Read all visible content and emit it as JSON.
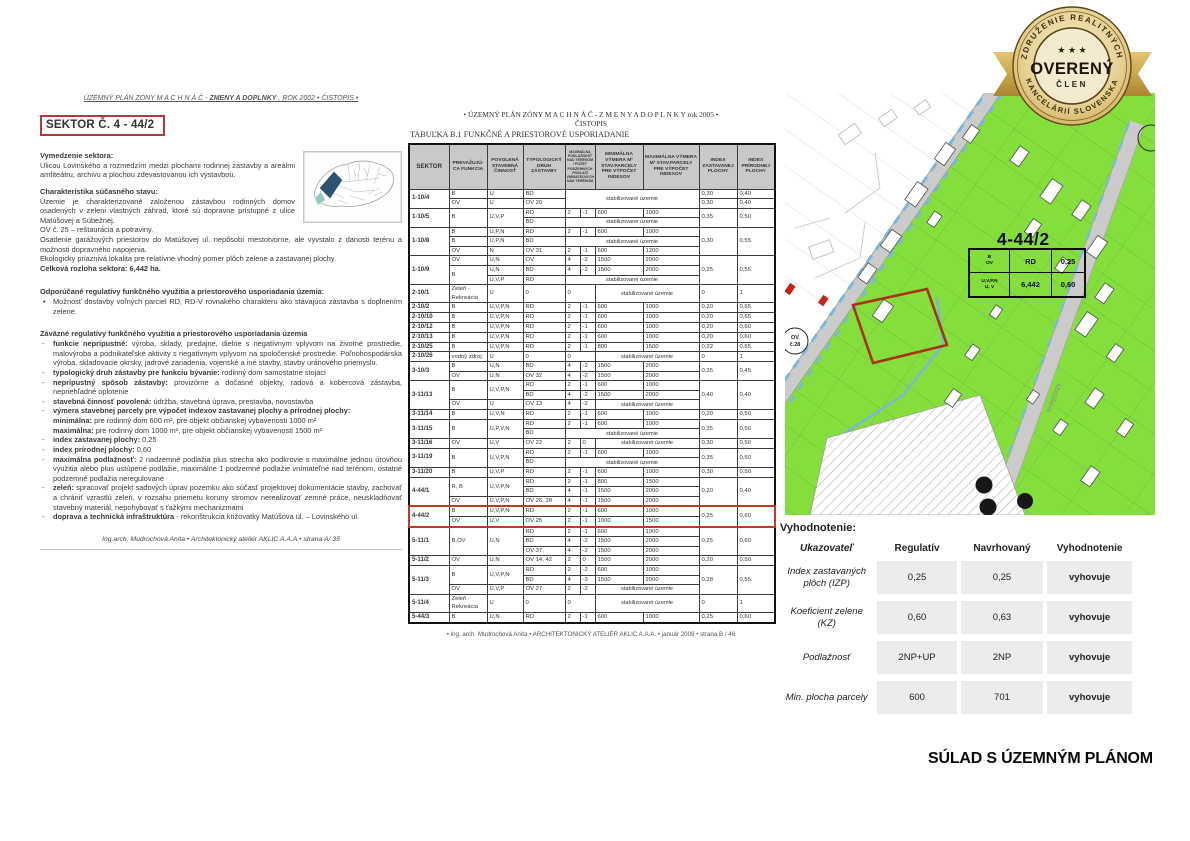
{
  "left_page": {
    "header": {
      "pre": "ÚZEMNÝ PLÁN ZÓNY  M A C H N Á Č  - ",
      "bold": "ZMENY A DOPLNKY",
      "post": " , ROK 2002 • ČISTOPIS •"
    },
    "sector_title": "SEKTOR Č. 4 - 44/2",
    "vymedzenie": {
      "heading": "Vymedzenie sektora:",
      "body": "Ulicou Lovinského a rozmedzím medzi plochami rodinnej zástavby a areálmi amfiteátru, archivu a plochou zdevastovanou ich výstavbou."
    },
    "charakteristika": {
      "heading": "Charakteristika súčasného stavu:",
      "paragraphs": [
        "Územie je charakterizované založenou zástavbou rodinných domov osadených v zeleni vlastných záhrad, ktoré sú dopravne prístupné z ulice Matúšovej a Súbežnej.",
        "OV č. 25 – reštaurácia a potraviny.",
        "Osadenie garážových priestorov do Matúšovej ul. nepôsobí mestotvorne, ale vyvstalo z danosti terénu a možnosti dopravného napojenia.",
        "Ekologicky priaznivá lokalita pre relatívne vhodný pomer plôch zelene a zastavanej plochy."
      ],
      "total": "Celková rozloha sektora: 6,442 ha."
    },
    "odporucane": {
      "heading": "Odporúčané regulatívy funkčného využitia a priestorového usporiadania územia:",
      "bullet": "Možnosť dostavby voľných parciel RD, RD-V rovnakého charakteru ako stávajúca zástavba s doplnením zelene."
    },
    "zavazne_heading": "Záväzné regulatívy funkčného využitia a priestorového usporiadania územia",
    "regulativy": [
      {
        "d": 1,
        "lead": "funkcie neprípustné:",
        "rest": "výroba, sklady, predajne, dielne s negatívnym vplyvom na životné prostredie, malovýroba a podnikateľské aktivity s negatívnym vplyvom na spoločenské prostredie. Poľnohospodárska výroba, skladovacie okrsky, jadrové zariadenia, vojenské a iné stavby, stavby uránového priemyslu."
      },
      {
        "d": 1,
        "lead": "typologický druh zástavby pre funkciu bývanie:",
        "rest": "rodinný dom samostatne stojaci"
      },
      {
        "d": 1,
        "lead": "neprípustný spôsob zástavby:",
        "rest": "provizórne a dočasné objekty, radová a kobercová zástavba, nepriehľadné oplotenie"
      },
      {
        "d": 1,
        "lead": "stavebná činnosť povolená:",
        "rest": "údržba, stavebná úprava, prestavba, novostavba"
      },
      {
        "d": 1,
        "lead": "výmera stavebnej parcely pre výpočet indexov zastavanej plochy a prírodnej plochy:",
        "rest": ""
      },
      {
        "d": 0,
        "lead": "minimálna:",
        "rest": "pre rodinný dom 600 m², pre objekt  občianskej vybavenosti 1000 m²"
      },
      {
        "d": 0,
        "lead": "maximálna:",
        "rest": "pre rodinný dom 1000 m², pre objekt občianskej vybavenosti 1500 m²"
      },
      {
        "d": 1,
        "lead": "index zastavanej plochy:",
        "rest": "0,25"
      },
      {
        "d": 1,
        "lead": "index prírodnej plochy:",
        "rest": "0,60"
      },
      {
        "d": 1,
        "lead": "maximálna podlažnosť:",
        "rest": "2 nadzemné podlažia  plus strecha ako podkrovie s maximálne jednou úrovňou využitia alebo plus ustúpené podlažie, maximálne 1 podzemné podlažie vnímateľné nad terénom, ostatné podzemné podlažia neregulované"
      },
      {
        "d": 1,
        "lead": "zeleň:",
        "rest": "spracovať projekt sadových úprav pozemku ako súčasť projektovej dokumentácie stavby, zachovať a chrániť vzrastlú zeleň, v rozsahu priemetu koruny stromov nerealizovať zemné práce, neuskladňovať stavebný materiál, nepohybovať s ťažkými mechanizmami"
      },
      {
        "d": 1,
        "lead": "doprava a technická infraštruktúra",
        "rest": "- rekonštrukcia križovatky Matúšova ul. – Lovinského ul."
      }
    ],
    "footer": "Ing.arch. Mudrochová Anita • Architektonický ateliér AKLIC A.A.A.• strana A/ 35"
  },
  "middle_page": {
    "header_line1": "• ÚZEMNÝ PLÁN ZÓNY   M A C H N Á Č - Z M E N Y  A  D O P L N K Y   rok 2005  •",
    "header_line2": "ČISTOPIS",
    "table_title": "TABUĽKA   B.1   FUNKČNÉ  A PRIESTOROVÉ   USPORIADANIE",
    "columns": [
      "SEKTOR",
      "PREVAŽUJÚ- CA FUNKCIA",
      "POVOLENÁ STAVEBNÁ ČINNOSŤ",
      "TYPOLOGICKÝ DRUH ZÁSTAVBY",
      "MAXIMÁLNA PODLAŽNOSŤ NAD TERÉNOM / POČET PODZEMNÝCH PODLAŽÍ VNÍMATEĽNÝCH NAD TERÉNOM",
      "MINIMÁLNA VÝMERA M² STAV.PARCELY PRE VÝPOČET INDEXOV",
      "MAXIMÁLNA VÝMERA M² STAV.PARCELY PRE VÝPOČET INDEXOV",
      "INDEX ZASTAVANEJ PLOCHY",
      "INDEX PRÍRODNEJ PLOCHY"
    ],
    "groups": [
      {
        "sektor": "1-10/4",
        "rows": [
          [
            "B",
            "U",
            "BD",
            {
              "t": "stabilizované územie",
              "cs": 4,
              "rs": 2,
              "cls": "stab"
            },
            "0,30",
            "0,40"
          ],
          [
            "OV",
            "U",
            "OV 20",
            "0,30",
            "0,40"
          ]
        ]
      },
      {
        "sektor": "1-10/5",
        "rows": [
          [
            {
              "t": "B",
              "rs": 2
            },
            {
              "t": "U,V,P",
              "rs": 2
            },
            "RD",
            "2",
            "-1",
            "600",
            "1000",
            {
              "t": "0,35",
              "rs": 2
            },
            {
              "t": "0,50",
              "rs": 2
            }
          ],
          [
            "BD",
            {
              "t": "stabilizované územie",
              "cs": 4,
              "cls": "stab"
            }
          ]
        ]
      },
      {
        "sektor": "1-10/8",
        "rows": [
          [
            "B",
            "U,P,N",
            "RD",
            "2",
            "-1",
            "600",
            "1000",
            {
              "t": "0,30",
              "rs": 3
            },
            {
              "t": "0,55",
              "rs": 3
            }
          ],
          [
            "B",
            "U,P,N",
            "BD",
            {
              "t": "stabilizované územie",
              "cs": 4,
              "cls": "stab"
            }
          ],
          [
            "OV",
            "N",
            "OV 31",
            "2",
            "-1",
            "600",
            "1200"
          ]
        ]
      },
      {
        "sektor": "1-10/9",
        "rows": [
          [
            "OV",
            "U,N",
            "OV",
            "4",
            "-2",
            "1500",
            "2000",
            {
              "t": "0,25",
              "rs": 3
            },
            {
              "t": "0,55",
              "rs": 3
            }
          ],
          [
            {
              "t": "B",
              "rs": 2
            },
            "U,N",
            "BD",
            "4",
            "-2",
            "1500",
            "2000"
          ],
          [
            "U,V,P",
            "RD",
            {
              "t": "stabilizované územie",
              "cs": 4,
              "cls": "stab"
            }
          ]
        ]
      },
      {
        "sektor": "2-10/1",
        "rows": [
          [
            "Zeleň - Rekreácia",
            "U",
            "0",
            {
              "t": "0",
              "cs": 2
            },
            {
              "t": "stabilizované územie",
              "cs": 2,
              "cls": "stab"
            },
            "0",
            "1"
          ]
        ]
      },
      {
        "sektor": "2-10/2",
        "rows": [
          [
            "B",
            "U,V,P,N",
            "RD",
            "2",
            "-1",
            "600",
            "1000",
            "0,20",
            "0,65"
          ]
        ]
      },
      {
        "sektor": "2-10/10",
        "rows": [
          [
            "B",
            "U,V,P,N",
            "RD",
            "2",
            "-1",
            "600",
            "1000",
            "0,20",
            "0,65"
          ]
        ]
      },
      {
        "sektor": "2-10/12",
        "rows": [
          [
            "B",
            "U,V,P,N",
            "RD",
            "2",
            "-1",
            "600",
            "1000",
            "0,20",
            "0,60"
          ]
        ]
      },
      {
        "sektor": "2-10/13",
        "rows": [
          [
            "B",
            "U,V,P,N",
            "RD",
            "2",
            "-1",
            "600",
            "1000",
            "0,20",
            "0,60"
          ]
        ]
      },
      {
        "sektor": "2-10/25",
        "rows": [
          [
            "B",
            "U,V,P,N",
            "RD",
            "2",
            "-1",
            "800",
            "1500",
            "0,22",
            "0,65"
          ]
        ]
      },
      {
        "sektor": "2-10/26",
        "rows": [
          [
            "vodný zdroj",
            "U",
            "0",
            {
              "t": "0",
              "cs": 2
            },
            {
              "t": "stabilizované územie",
              "cs": 2,
              "cls": "stab"
            },
            "0",
            "1"
          ]
        ]
      },
      {
        "sektor": "3-10/3",
        "rows": [
          [
            "B",
            "U,N",
            "BD",
            "4",
            "-2",
            "1500",
            "2000",
            {
              "t": "0,35",
              "rs": 2
            },
            {
              "t": "0,45",
              "rs": 2
            }
          ],
          [
            "OV",
            "U,N",
            "OV 32",
            "4",
            "-2",
            "1500",
            "2000"
          ]
        ]
      },
      {
        "sektor": "3-11/13",
        "rows": [
          [
            {
              "t": "B",
              "rs": 2
            },
            {
              "t": "U,V,P,N",
              "rs": 2
            },
            "RD",
            "2",
            "-1",
            "600",
            "1000",
            {
              "t": "0,40",
              "rs": 3
            },
            {
              "t": "0,40",
              "rs": 3
            }
          ],
          [
            "BD",
            "4",
            "-2",
            "1500",
            "2000"
          ],
          [
            "OV",
            "U",
            "OV 13",
            "4",
            "-2",
            {
              "t": "stabilizované územie",
              "cs": 2,
              "cls": "stab"
            }
          ]
        ]
      },
      {
        "sektor": "3-11/14",
        "rows": [
          [
            "B",
            "U,V,N",
            "RD",
            "2",
            "-1",
            "600",
            "1000",
            "0,20",
            "0,50"
          ]
        ]
      },
      {
        "sektor": "3-11/15",
        "rows": [
          [
            {
              "t": "B",
              "rs": 2
            },
            {
              "t": "U,P,V,N",
              "rs": 2
            },
            "RD",
            "2",
            "-1",
            "600",
            "1000",
            {
              "t": "0,35",
              "rs": 2
            },
            {
              "t": "0,50",
              "rs": 2
            }
          ],
          [
            "BD",
            {
              "t": "stabilizované územie",
              "cs": 4,
              "cls": "stab"
            }
          ]
        ]
      },
      {
        "sektor": "3-11/16",
        "rows": [
          [
            "OV",
            "U,V",
            "OV 22",
            "2",
            "0",
            {
              "t": "stabilizované územie",
              "cs": 2,
              "cls": "stab"
            },
            "0,30",
            "0,50"
          ]
        ]
      },
      {
        "sektor": "3-11/19",
        "rows": [
          [
            {
              "t": "B",
              "rs": 2
            },
            {
              "t": "U,V,P,N",
              "rs": 2
            },
            "RD",
            "2",
            "-1",
            "600",
            "1000",
            {
              "t": "0,35",
              "rs": 2
            },
            {
              "t": "0,50",
              "rs": 2
            }
          ],
          [
            "BD",
            {
              "t": "stabilizované územie",
              "cs": 4,
              "cls": "stab"
            }
          ]
        ]
      },
      {
        "sektor": "3-11/20",
        "rows": [
          [
            "B",
            "U,V,P",
            "RD",
            "2",
            "-1",
            "600",
            "1000",
            "0,30",
            "0,50"
          ]
        ]
      },
      {
        "sektor": "4-44/1",
        "rows": [
          [
            {
              "t": "R, B",
              "rs": 2
            },
            {
              "t": "U,V,P,N",
              "rs": 2
            },
            "RD",
            "2",
            "-1",
            "800",
            "1500",
            {
              "t": "0,20",
              "rs": 3
            },
            {
              "t": "0,40",
              "rs": 3
            }
          ],
          [
            "BD",
            "4",
            "-1",
            "1500",
            "2000"
          ],
          [
            "OV",
            "U,V,P,N",
            "OV 26, 28",
            "4",
            "-1",
            "1500",
            "2000"
          ]
        ]
      },
      {
        "sektor": "4-44/2",
        "hl": true,
        "rows": [
          [
            "B",
            "U,V,P,N",
            "RD",
            "2",
            "-1",
            "600",
            "1000",
            {
              "t": "0,25",
              "rs": 2
            },
            {
              "t": "0,60",
              "rs": 2
            }
          ],
          [
            "OV",
            "U,V",
            "OV 25",
            "2",
            "-1",
            "1000",
            "1500"
          ]
        ]
      },
      {
        "sektor": "5-11/1",
        "rows": [
          [
            {
              "t": "B,OV",
              "rs": 3
            },
            {
              "t": "U,N",
              "rs": 3
            },
            "RD",
            "2",
            "-1",
            "600",
            "1000",
            {
              "t": "0,25",
              "rs": 3
            },
            {
              "t": "0,60",
              "rs": 3
            }
          ],
          [
            "BD",
            "4",
            "-2",
            "1500",
            "2000"
          ],
          [
            "OV 37,",
            "4",
            "-2",
            "1500",
            "2000"
          ]
        ]
      },
      {
        "sektor": "5-11/2",
        "rows": [
          [
            "OV",
            "U,N",
            "OV 14, 42",
            "2",
            "0",
            "1500",
            "2000",
            "0,20",
            "0,50"
          ]
        ]
      },
      {
        "sektor": "5-11/3",
        "rows": [
          [
            {
              "t": "B",
              "rs": 2
            },
            {
              "t": "U,V,P,N",
              "rs": 2
            },
            "RD",
            "2",
            "-2",
            "600",
            "1000",
            {
              "t": "0,28",
              "rs": 3
            },
            {
              "t": "0,55",
              "rs": 3
            }
          ],
          [
            "BD",
            "4",
            "-3",
            "1500",
            "2000"
          ],
          [
            "OV",
            "U,V,P",
            "OV 27",
            "2",
            "-2",
            {
              "t": "stabilizované územie",
              "cs": 2,
              "cls": "stab"
            }
          ]
        ]
      },
      {
        "sektor": "5-11/4",
        "rows": [
          [
            "Zeleň - Rekreácia",
            "U",
            "0",
            {
              "t": "0",
              "cs": 2
            },
            {
              "t": "stabilizované územie",
              "cs": 2,
              "cls": "stab"
            },
            "0",
            "1"
          ]
        ]
      },
      {
        "sektor": "5-44/3",
        "rows": [
          [
            "B",
            "U,N",
            "RD",
            "2",
            "-1",
            "600",
            "1000",
            "0,25",
            "0,60"
          ]
        ]
      }
    ],
    "footer": "•  ing. arch. Mudrochová Anita • ARCHITEKTONICKÝ  ATELIÉR AKLIC  A.A.A.   • január 2009 •      strana B   / 46"
  },
  "badge": {
    "arc_top": "ZDRUŽENIE  REALITNÝCH",
    "arc_bottom": "KANCELÁRIÍ  SLOVENSKA",
    "stars": "★ ★ ★",
    "center": "OVERENÝ",
    "sub": "ČLEN",
    "gold": "#c9a84c"
  },
  "map": {
    "sector_label": "4-44/2",
    "info_rows": [
      [
        "B\nOV",
        "RD",
        "0,25"
      ],
      [
        "U,V,P,N\nU, V",
        "6,442",
        "0,60"
      ]
    ],
    "ov_circle": "OV\nč.28",
    "street": "Matúšova",
    "zone_green": "#84df3c",
    "parcel_red": "#a8330e"
  },
  "evaluation": {
    "title": "Vyhodnotenie:",
    "columns": [
      "Ukazovateľ",
      "Regulatív",
      "Navrhovaný",
      "Vyhodnotenie"
    ],
    "rows": [
      [
        "Index zastavaných plôch (IZP)",
        "0,25",
        "0,25",
        "vyhovuje"
      ],
      [
        "Koeficient zelene (KZ)",
        "0,60",
        "0,63",
        "vyhovuje"
      ],
      [
        "Podlažnosť",
        "2NP+UP",
        "2NP",
        "vyhovuje"
      ],
      [
        "Min. plocha parcely",
        "600",
        "701",
        "vyhovuje"
      ]
    ]
  },
  "stamp": "SÚLAD S ÚZEMNÝM PLÁNOM"
}
